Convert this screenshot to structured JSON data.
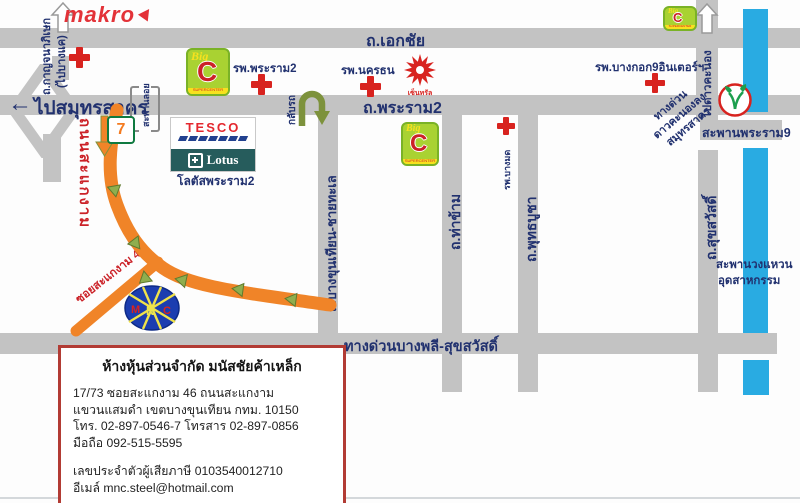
{
  "map": {
    "landmarks": {
      "makro": "makro",
      "seven_eleven": "7",
      "tesco": "TESCO",
      "lotus": "Lotus",
      "lotus_caption": "โลตัสพระราม2",
      "bigc": {
        "big": "Big",
        "c": "C",
        "strip": "SUPERCENTER"
      },
      "central": "เซ็นทรัล",
      "mnc": {
        "m": "M",
        "n": "N",
        "c": "C"
      }
    },
    "hospitals": {
      "rama2": "รพ.พระราม2",
      "nakhonthon": "รพ.นครธน",
      "bangkok9": "รพ.บางกอก9อินเตอร์ฯ",
      "bangmod": "รพ.บางมด"
    },
    "roads": {
      "ekachai": "ถ.เอกชัย",
      "rama2": "ถ.พระราม2",
      "left_arrow": "←",
      "to_samutsakhon": "ไปสมุทรสาคร",
      "kanchanaphisek": "ถ.กาญจนาภิเษก",
      "to_bangkhae": "(ไปบางแค)",
      "sakae_ngam": "ถนนสะแกงาม",
      "soi_sakae_ngam_46": "ซอยสะแกงาม 46",
      "bangkhunthian_chaithale": "ถ.บางขุนเทียน-ชายทะเล",
      "thakham": "ถ.ท่าข้าม",
      "phutthabucha": "ถ.พุทธบูชา",
      "suksawat": "ถ.สุขสวัสดิ์",
      "to_daokhanong": "ไปดาวคะนอง",
      "u_turn": "กลับรถ",
      "footbridge": "สะพานลอย",
      "expressway": "ทางด่วนบางพลี-สุขสวัสดิ์",
      "rama9_bridge": "สะพานพระราม9",
      "industrial_ring_line1": "สะพานวงแหวน",
      "industrial_ring_line2": "อุดสาหกรรม",
      "daokhanong_exit_line1": "ทางด่วน",
      "daokhanong_exit_line2": "ดาวคะนองลง",
      "daokhanong_exit_line3": "สมุทรสาคร"
    },
    "infobox": {
      "title": "ห้างหุ้นส่วนจำกัด มนัสชัยค้าเหล็ก",
      "address_line1": "17/73 ซอยสะแกงาม 46 ถนนสะแกงาม",
      "address_line2": "แขวนแสมดำ เขตบางขุนเทียน กทม. 10150",
      "phone_line": "โทร. 02-897-0546-7 โทรสาร 02-897-0856",
      "mobile_line": "มือถือ 092-515-5595",
      "tax_line": "เลขประจำตัวผู้เสียภาษี 0103540012710",
      "email_line": "อีเมล์ mnc.steel@hotmail.com"
    },
    "colors": {
      "road_gray": "#c3c3c3",
      "label_navy": "#21316f",
      "highlight_orange": "#f08428",
      "arrow_green": "#8fae4e",
      "canal_blue": "#29abe2",
      "red": "#d8231f",
      "infobox_border": "#b23b34"
    }
  }
}
